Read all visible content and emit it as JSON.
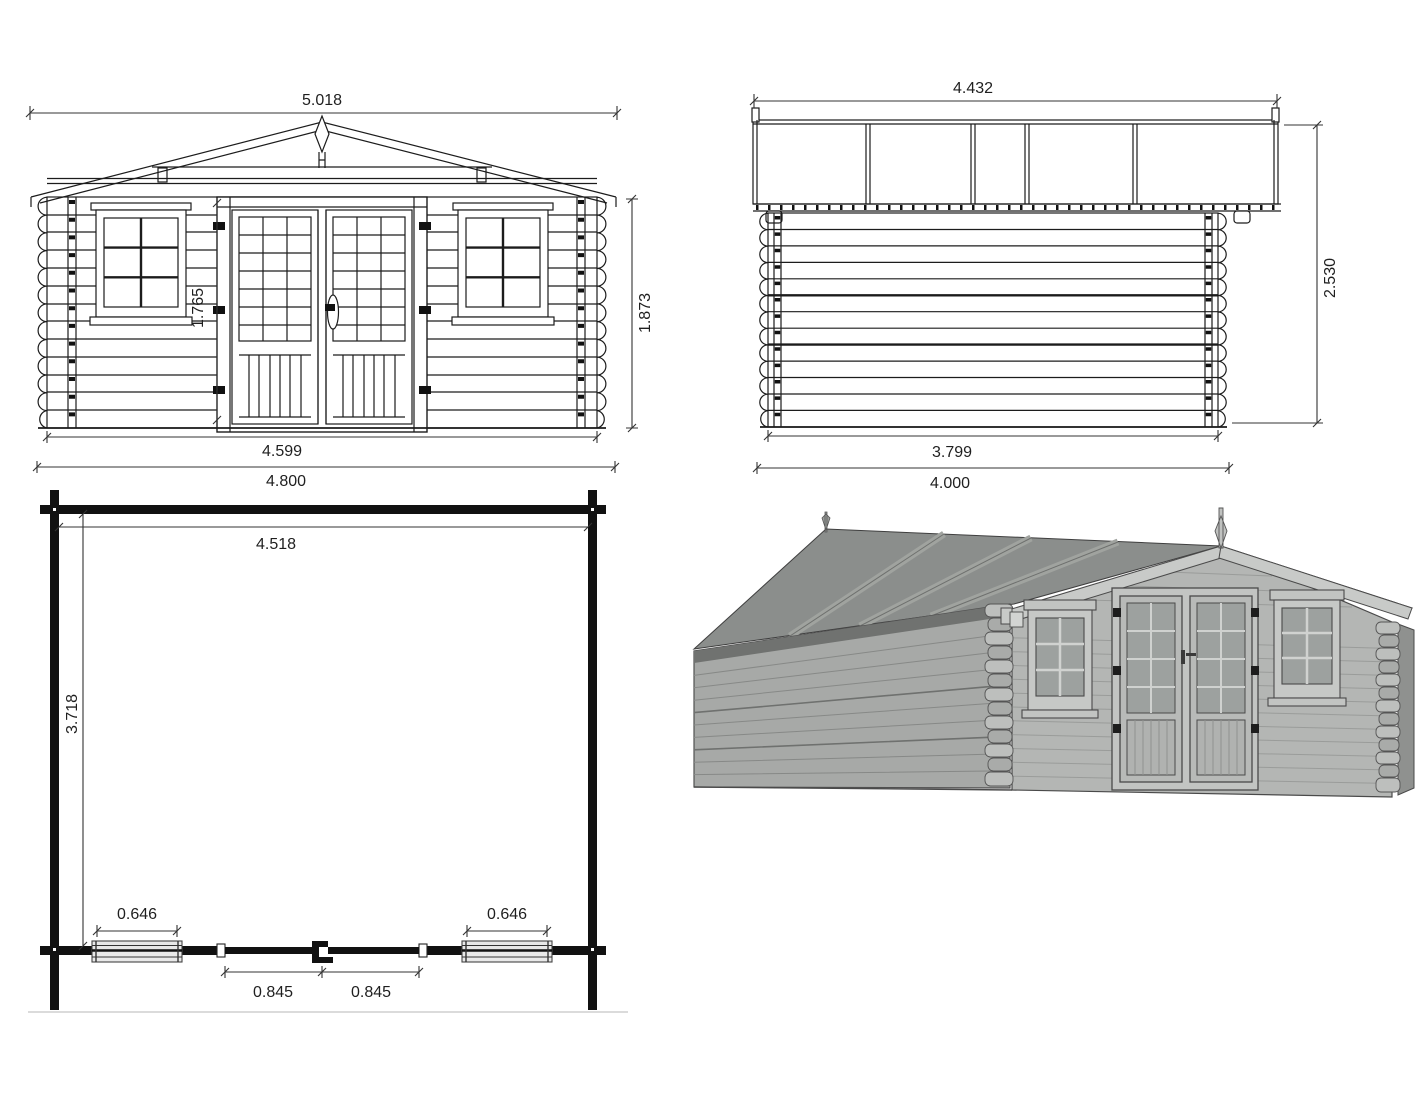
{
  "views": {
    "front_elevation": {
      "dims": {
        "roof_width": "5.018",
        "door_height": "1.765",
        "wall_height": "1.873",
        "wall_width": "4.599",
        "overall_width": "4.800"
      }
    },
    "side_elevation": {
      "dims": {
        "roof_length": "4.432",
        "overall_height": "2.530",
        "wall_length": "3.799",
        "overall_length": "4.000"
      }
    },
    "floor_plan": {
      "dims": {
        "inner_width": "4.518",
        "inner_depth": "3.718",
        "window_left": "0.646",
        "window_right": "0.646",
        "door_leaf_left": "0.845",
        "door_leaf_right": "0.845"
      }
    },
    "colors": {
      "line": "#1c1c1c",
      "dim_text": "#1f1f1f",
      "roof_3d": "#8b8e8c",
      "roof_batten_3d": "#a0a39f",
      "wall_front_3d": "#b4b6b4",
      "wall_side_3d": "#a7a9a7",
      "trim_3d": "#c8cac8",
      "glass_3d": "#9da19f"
    }
  }
}
